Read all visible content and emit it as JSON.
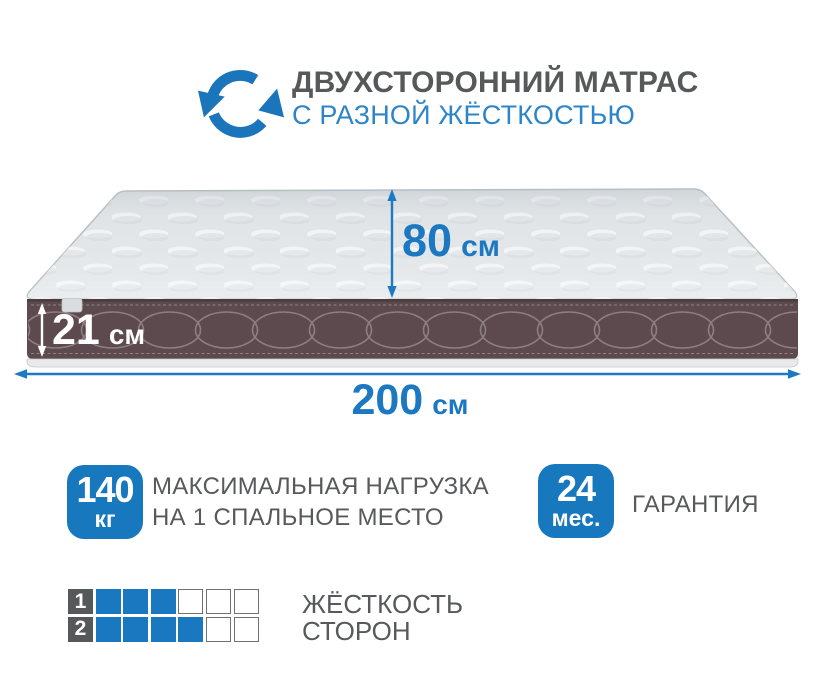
{
  "header": {
    "title": "ДВУХСТОРОННИЙ МАТРАС",
    "subtitle": "С РАЗНОЙ ЖЁСТКОСТЬЮ",
    "icon": "rotate-arrows-icon"
  },
  "dimensions": {
    "depth": {
      "value": "80",
      "unit": "см"
    },
    "height": {
      "value": "21",
      "unit": "см"
    },
    "length": {
      "value": "200",
      "unit": "см"
    }
  },
  "badges": {
    "max_load": {
      "value": "140",
      "unit": "кг",
      "line1": "МАКСИМАЛЬНАЯ НАГРУЗКА",
      "line2": "НА 1 СПАЛЬНОЕ МЕСТО"
    },
    "warranty": {
      "value": "24",
      "unit": "мес.",
      "label": "ГАРАНТИЯ"
    }
  },
  "firmness": {
    "title_line1": "ЖЁСТКОСТЬ",
    "title_line2": "СТОРОН",
    "scale_max": 6,
    "rows": [
      {
        "side": "1",
        "filled": 3
      },
      {
        "side": "2",
        "filled": 4
      }
    ]
  },
  "colors": {
    "accent_blue": "#1a78c0",
    "subtitle_blue": "#2d85c8",
    "text_gray": "#58595b",
    "band_brown": "#5d4a4e",
    "mattress_top": "#e0e4e6"
  }
}
